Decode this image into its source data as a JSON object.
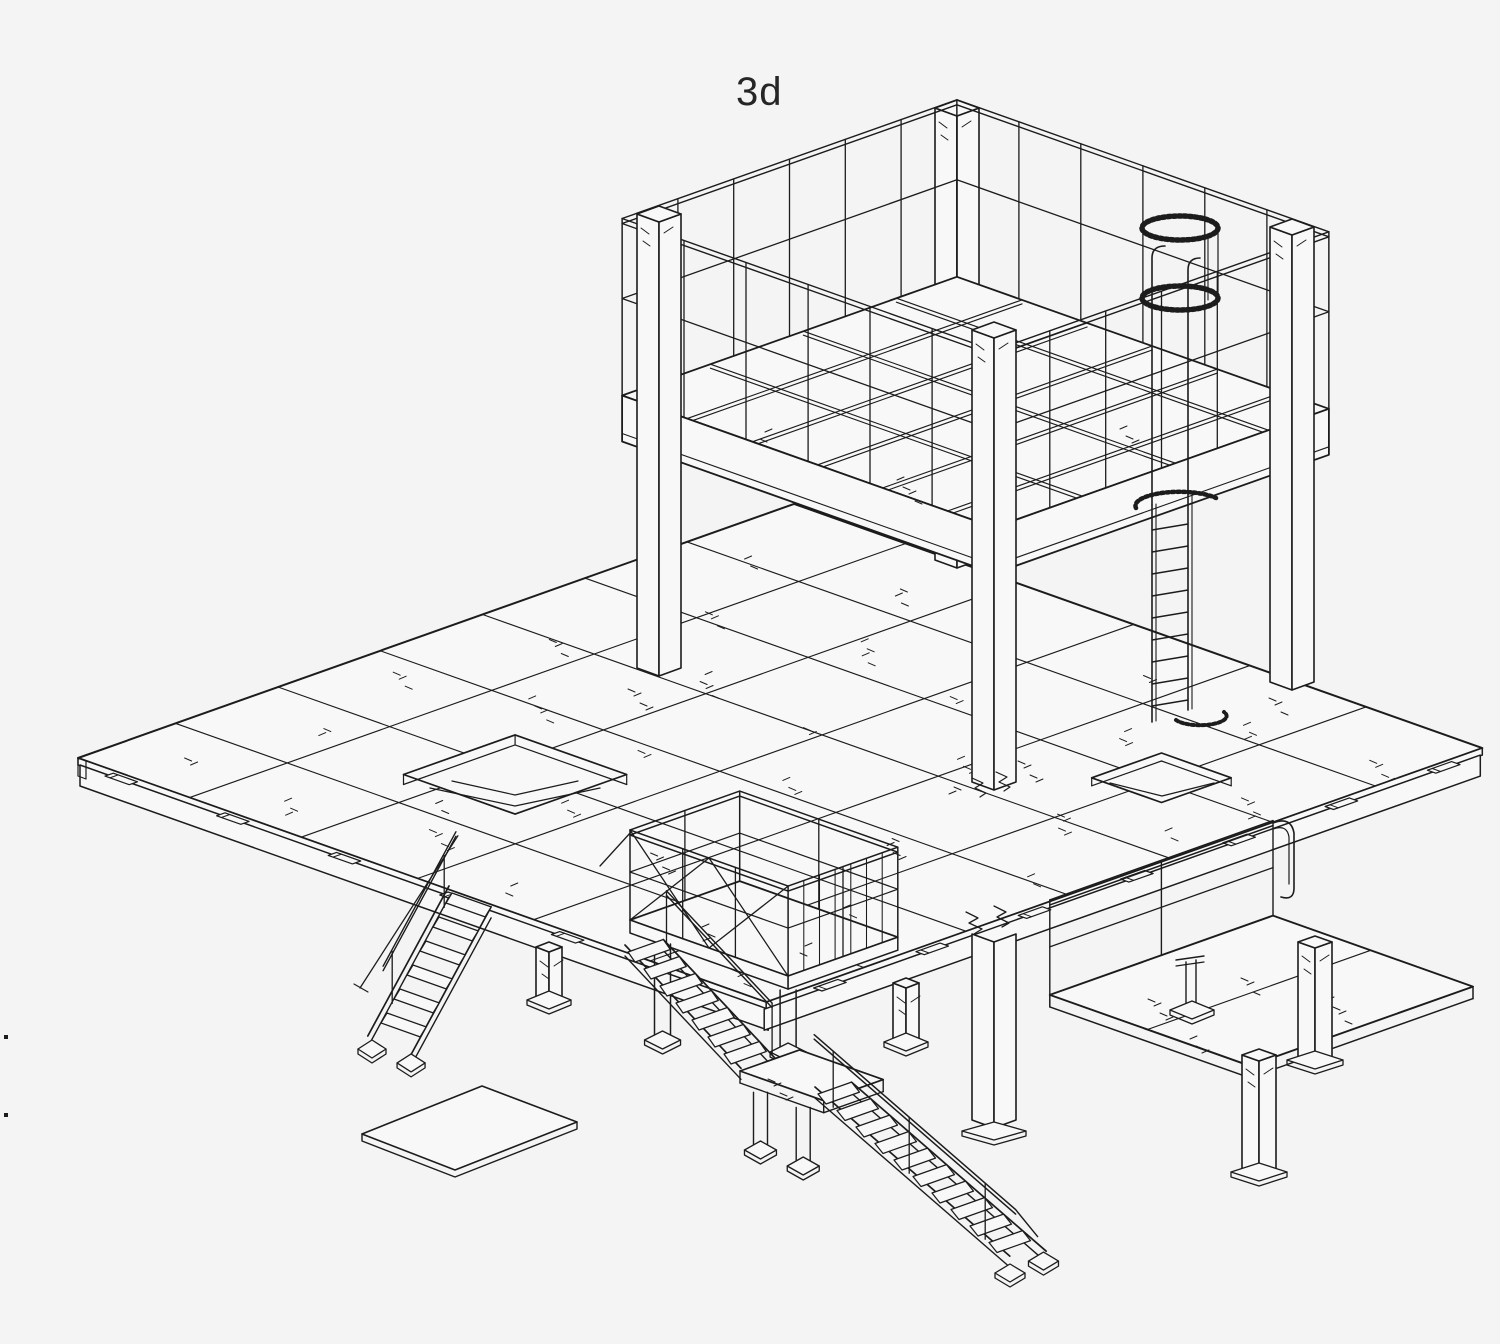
{
  "figure": {
    "label": "3d"
  },
  "style": {
    "background": "#f3f4f3",
    "panel_fill": "#f7f8f7",
    "line_color": "#1c1c1c",
    "label_color": "#262626"
  },
  "scene": {
    "width": 1500,
    "height": 1344,
    "description": "Isometric CAD line drawing of a two-storey steel mezzanine structure: upper guard-railed platform tower with caged access ladder, large panelled floor deck with two openings, switchback caged stair, side access stair, lower side platform and a loose floor panel"
  }
}
